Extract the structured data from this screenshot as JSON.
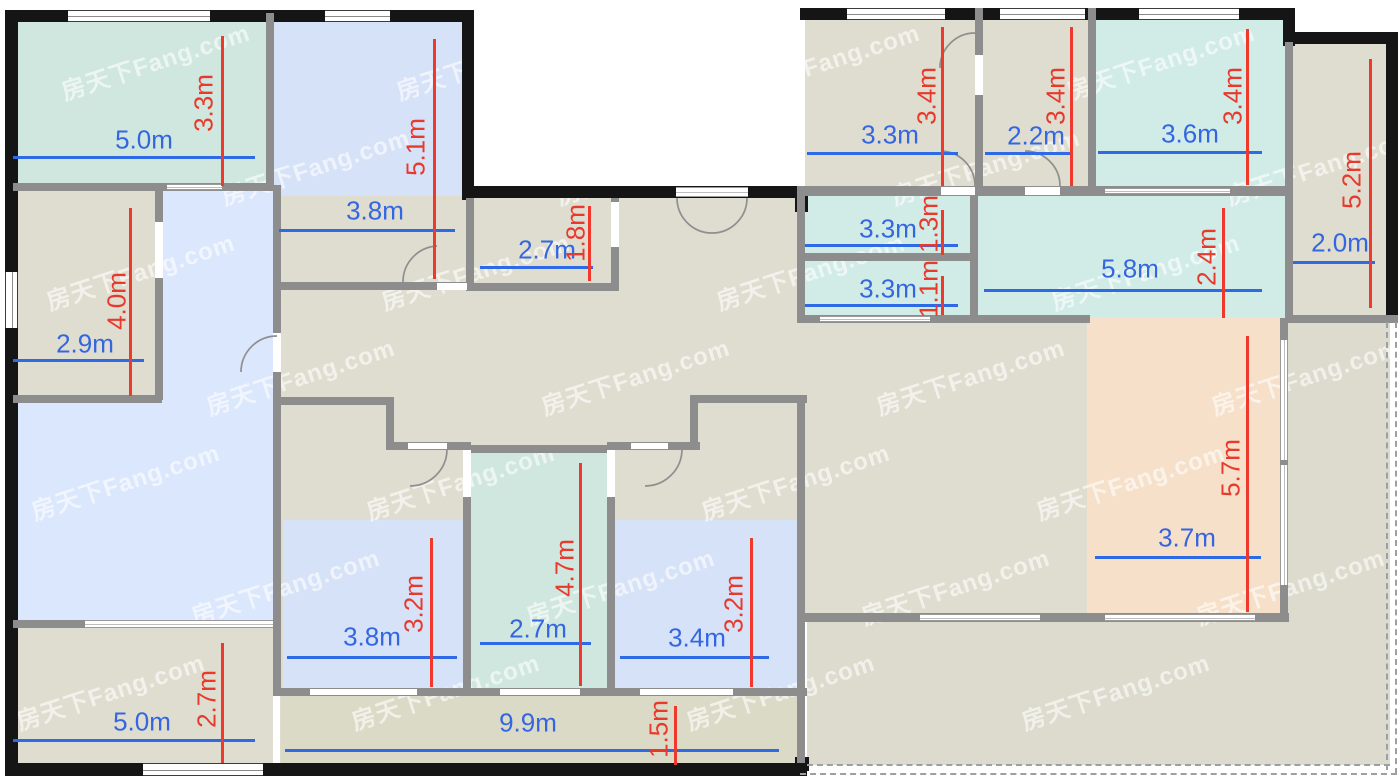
{
  "floorplan": {
    "width": 1400,
    "height": 779,
    "colors": {
      "wall_black": "#151515",
      "wall_gray": "#8d8d8d",
      "door_stroke": "#8f8f8f",
      "dash": "#9aa0a4",
      "dim_blue": "#2e6ae6",
      "dim_blue_text": "#3466e2",
      "dim_red": "#ee392c",
      "dim_red_text": "#e83a2c",
      "hall": "#deddcf",
      "balcony": "#dbdac7",
      "terrace": "#dcdbcd",
      "teal_a": "#cfe7de",
      "teal_b": "#d1ebe7",
      "blue_room": "#d6e2f8",
      "blue_living": "#dbe7fc",
      "peach": "#f6e0c9",
      "opening": "#ffffff"
    },
    "watermark": {
      "text": "房天下Fang.com",
      "color": "rgba(255,255,255,0.6)",
      "font_size": 24,
      "rotation": -18,
      "positions": [
        [
          155,
          60
        ],
        [
          490,
          60
        ],
        [
          825,
          60
        ],
        [
          1160,
          60
        ],
        [
          315,
          165
        ],
        [
          650,
          165
        ],
        [
          985,
          165
        ],
        [
          1320,
          165
        ],
        [
          140,
          270
        ],
        [
          475,
          270
        ],
        [
          810,
          270
        ],
        [
          1145,
          270
        ],
        [
          300,
          375
        ],
        [
          635,
          375
        ],
        [
          970,
          375
        ],
        [
          1305,
          375
        ],
        [
          125,
          480
        ],
        [
          460,
          480
        ],
        [
          795,
          480
        ],
        [
          1130,
          480
        ],
        [
          285,
          585
        ],
        [
          620,
          585
        ],
        [
          955,
          585
        ],
        [
          1290,
          585
        ],
        [
          110,
          690
        ],
        [
          445,
          690
        ],
        [
          780,
          690
        ],
        [
          1115,
          690
        ]
      ]
    },
    "fills": [
      {
        "name": "bedroom-top-left",
        "x": 13,
        "y": 13,
        "w": 253,
        "h": 172,
        "c": "teal_a"
      },
      {
        "name": "bedroom-5-1",
        "x": 273,
        "y": 13,
        "w": 191,
        "h": 271,
        "c": "blue_room"
      },
      {
        "name": "room-2-9",
        "x": 13,
        "y": 185,
        "w": 148,
        "h": 212,
        "c": "hall"
      },
      {
        "name": "corridor",
        "x": 161,
        "y": 189,
        "w": 112,
        "h": 215,
        "c": "blue_living"
      },
      {
        "name": "living-room",
        "x": 13,
        "y": 400,
        "w": 260,
        "h": 222,
        "c": "blue_living"
      },
      {
        "name": "room-bottom-left",
        "x": 13,
        "y": 626,
        "w": 260,
        "h": 139,
        "c": "hall"
      },
      {
        "name": "hall-left-wing",
        "x": 280,
        "y": 196,
        "w": 520,
        "h": 568,
        "c": "hall"
      },
      {
        "name": "balcony-bottom",
        "x": 281,
        "y": 694,
        "w": 519,
        "h": 70,
        "c": "balcony"
      },
      {
        "name": "hall-right-wing",
        "x": 800,
        "y": 196,
        "w": 290,
        "h": 419,
        "c": "hall"
      },
      {
        "name": "terrace-bottom",
        "x": 807,
        "y": 613,
        "w": 583,
        "h": 152,
        "c": "terrace"
      },
      {
        "name": "terrace-right",
        "x": 1285,
        "y": 318,
        "w": 105,
        "h": 297,
        "c": "terrace"
      },
      {
        "name": "room-top-right-1",
        "x": 805,
        "y": 13,
        "w": 172,
        "h": 175,
        "c": "hall"
      },
      {
        "name": "room-top-right-2",
        "x": 981,
        "y": 13,
        "w": 109,
        "h": 175,
        "c": "hall"
      },
      {
        "name": "room-3-6",
        "x": 1094,
        "y": 13,
        "w": 191,
        "h": 175,
        "c": "teal_b"
      },
      {
        "name": "room-1-3",
        "x": 803,
        "y": 194,
        "w": 169,
        "h": 61,
        "c": "teal_b"
      },
      {
        "name": "room-1-1",
        "x": 803,
        "y": 259,
        "w": 169,
        "h": 58,
        "c": "teal_b"
      },
      {
        "name": "area-5-8",
        "x": 976,
        "y": 194,
        "w": 312,
        "h": 124,
        "c": "teal_b"
      },
      {
        "name": "room-2-0",
        "x": 1291,
        "y": 42,
        "w": 97,
        "h": 275,
        "c": "hall"
      },
      {
        "name": "room-peach",
        "x": 1087,
        "y": 318,
        "w": 195,
        "h": 297,
        "c": "peach"
      },
      {
        "name": "roomA-blue",
        "x": 283,
        "y": 520,
        "w": 181,
        "h": 170,
        "c": "blue_room"
      },
      {
        "name": "roomB-teal",
        "x": 470,
        "y": 450,
        "w": 138,
        "h": 240,
        "c": "teal_a"
      },
      {
        "name": "roomC-blue",
        "x": 614,
        "y": 520,
        "w": 184,
        "h": 170,
        "c": "blue_room"
      }
    ],
    "black_walls": [
      [
        5,
        10,
        465,
        12
      ],
      [
        5,
        10,
        13,
        766
      ],
      [
        5,
        763,
        802,
        13
      ],
      [
        462,
        10,
        12,
        190
      ],
      [
        462,
        186,
        345,
        12
      ],
      [
        800,
        8,
        490,
        12
      ],
      [
        1283,
        8,
        12,
        38
      ],
      [
        1283,
        32,
        115,
        12
      ],
      [
        1386,
        32,
        12,
        286
      ],
      [
        795,
        186,
        13,
        26
      ],
      [
        795,
        757,
        14,
        14
      ]
    ],
    "gray_walls": [
      [
        13,
        183,
        253,
        8
      ],
      [
        266,
        13,
        8,
        178
      ],
      [
        155,
        190,
        8,
        210
      ],
      [
        13,
        395,
        149,
        8
      ],
      [
        273,
        185,
        8,
        503
      ],
      [
        13,
        620,
        75,
        8
      ],
      [
        273,
        397,
        120,
        8
      ],
      [
        386,
        397,
        8,
        53
      ],
      [
        386,
        442,
        84,
        8
      ],
      [
        463,
        442,
        8,
        251
      ],
      [
        470,
        445,
        140,
        8
      ],
      [
        607,
        442,
        8,
        251
      ],
      [
        614,
        442,
        86,
        8
      ],
      [
        690,
        397,
        8,
        53
      ],
      [
        690,
        395,
        117,
        8
      ],
      [
        273,
        688,
        534,
        8
      ],
      [
        800,
        186,
        490,
        10
      ],
      [
        797,
        253,
        181,
        8
      ],
      [
        797,
        315,
        293,
        8
      ],
      [
        1285,
        315,
        113,
        8
      ],
      [
        970,
        186,
        8,
        137
      ],
      [
        975,
        8,
        8,
        180
      ],
      [
        1088,
        8,
        8,
        180
      ],
      [
        1285,
        42,
        8,
        278
      ],
      [
        1280,
        318,
        8,
        303
      ],
      [
        797,
        613,
        492,
        9
      ],
      [
        797,
        186,
        8,
        137
      ],
      [
        611,
        198,
        8,
        92
      ],
      [
        466,
        283,
        153,
        8
      ],
      [
        466,
        198,
        8,
        92
      ],
      [
        273,
        282,
        194,
        8
      ],
      [
        797,
        395,
        8,
        368
      ]
    ],
    "ext_windows": [
      {
        "x": 68,
        "y": 10,
        "w": 142,
        "h": 12,
        "o": "h"
      },
      {
        "x": 325,
        "y": 10,
        "w": 65,
        "h": 12,
        "o": "h"
      },
      {
        "x": 847,
        "y": 8,
        "w": 98,
        "h": 12,
        "o": "h"
      },
      {
        "x": 1000,
        "y": 8,
        "w": 85,
        "h": 12,
        "o": "h"
      },
      {
        "x": 1139,
        "y": 8,
        "w": 100,
        "h": 12,
        "o": "h"
      },
      {
        "x": 5,
        "y": 272,
        "w": 13,
        "h": 56,
        "o": "v"
      },
      {
        "x": 143,
        "y": 763,
        "w": 120,
        "h": 13,
        "o": "h"
      }
    ],
    "white_openings": [
      [
        155,
        222,
        8,
        56
      ],
      [
        273,
        333,
        8,
        39
      ],
      [
        408,
        443,
        39,
        6
      ],
      [
        463,
        450,
        8,
        47
      ],
      [
        607,
        450,
        8,
        47
      ],
      [
        631,
        443,
        37,
        6
      ],
      [
        310,
        689,
        107,
        6
      ],
      [
        500,
        689,
        80,
        6
      ],
      [
        640,
        689,
        93,
        6
      ],
      [
        941,
        187,
        34,
        8
      ],
      [
        1025,
        187,
        35,
        8
      ],
      [
        975,
        55,
        8,
        40
      ],
      [
        611,
        202,
        8,
        45
      ],
      [
        437,
        283,
        30,
        7
      ]
    ],
    "lined_openings": [
      {
        "x": 167,
        "y": 184,
        "w": 55,
        "h": 6,
        "o": "h"
      },
      {
        "x": 85,
        "y": 620,
        "w": 188,
        "h": 8,
        "o": "h"
      },
      {
        "x": 676,
        "y": 187,
        "w": 72,
        "h": 10,
        "o": "h"
      },
      {
        "x": 1105,
        "y": 188,
        "w": 125,
        "h": 6,
        "o": "h"
      },
      {
        "x": 820,
        "y": 316,
        "w": 110,
        "h": 6,
        "o": "h"
      },
      {
        "x": 1280,
        "y": 340,
        "w": 8,
        "h": 120,
        "o": "v"
      },
      {
        "x": 1280,
        "y": 465,
        "w": 8,
        "h": 120,
        "o": "v"
      },
      {
        "x": 920,
        "y": 614,
        "w": 120,
        "h": 7,
        "o": "h"
      },
      {
        "x": 1105,
        "y": 614,
        "w": 150,
        "h": 7,
        "o": "h"
      }
    ],
    "dashed": [
      {
        "x": 1386,
        "y": 322,
        "len": 448,
        "o": "v"
      },
      {
        "x": 1395,
        "y": 322,
        "len": 452,
        "o": "v"
      },
      {
        "x": 807,
        "y": 764,
        "len": 583,
        "o": "h"
      },
      {
        "x": 800,
        "y": 773,
        "len": 597,
        "o": "h"
      }
    ],
    "doors": [
      "M 677 198 A 35 35 0 0 0 712 233",
      "M 747 198 A 35 35 0 0 1 712 233",
      "M 403 282 A 36 36 0 0 1 437 246",
      "M 277 336 A 36 36 0 0 0 241 372",
      "M 410 486 A 37 37 0 0 0 447 449",
      "M 645 486 A 37 37 0 0 0 682 449",
      "M 941 151 A 35 35 0 0 1 975 186",
      "M 1025 151 A 35 35 0 0 1 1060 186",
      "M 940 68 A 35 35 0 0 1 975 33"
    ],
    "dims_h": [
      {
        "label": "5.0m",
        "x1": 13,
        "x2": 265,
        "y": 157,
        "lx": 144,
        "ly": 140
      },
      {
        "label": "3.8m",
        "x1": 279,
        "x2": 465,
        "y": 230,
        "lx": 375,
        "ly": 211
      },
      {
        "label": "2.7m",
        "x1": 480,
        "x2": 603,
        "y": 267,
        "lx": 547,
        "ly": 250
      },
      {
        "label": "2.9m",
        "x1": 13,
        "x2": 154,
        "y": 360,
        "lx": 85,
        "ly": 344
      },
      {
        "label": "3.3m",
        "x1": 807,
        "x2": 968,
        "y": 153,
        "lx": 890,
        "ly": 135
      },
      {
        "label": "2.2m",
        "x1": 985,
        "x2": 1082,
        "y": 153,
        "lx": 1036,
        "ly": 136
      },
      {
        "label": "3.6m",
        "x1": 1098,
        "x2": 1272,
        "y": 152,
        "lx": 1190,
        "ly": 134
      },
      {
        "label": "3.3m",
        "x1": 805,
        "x2": 968,
        "y": 245,
        "lx": 888,
        "ly": 229
      },
      {
        "label": "3.3m",
        "x1": 805,
        "x2": 968,
        "y": 305,
        "lx": 888,
        "ly": 289
      },
      {
        "label": "5.8m",
        "x1": 984,
        "x2": 1272,
        "y": 290,
        "lx": 1130,
        "ly": 269
      },
      {
        "label": "2.0m",
        "x1": 1293,
        "x2": 1385,
        "y": 262,
        "lx": 1340,
        "ly": 243
      },
      {
        "label": "3.7m",
        "x1": 1095,
        "x2": 1271,
        "y": 557,
        "lx": 1187,
        "ly": 538
      },
      {
        "label": "3.8m",
        "x1": 287,
        "x2": 467,
        "y": 657,
        "lx": 372,
        "ly": 637
      },
      {
        "label": "2.7m",
        "x1": 480,
        "x2": 601,
        "y": 643,
        "lx": 538,
        "ly": 629
      },
      {
        "label": "3.4m",
        "x1": 620,
        "x2": 779,
        "y": 657,
        "lx": 697,
        "ly": 638
      },
      {
        "label": "5.0m",
        "x1": 13,
        "x2": 265,
        "y": 740,
        "lx": 142,
        "ly": 722
      },
      {
        "label": "9.9m",
        "x1": 285,
        "x2": 789,
        "y": 750,
        "lx": 528,
        "ly": 723
      }
    ],
    "dims_v": [
      {
        "label": "3.3m",
        "x": 222,
        "y1": 25,
        "y2": 186,
        "lx": 204,
        "ly": 103
      },
      {
        "label": "5.1m",
        "x": 434,
        "y1": 28,
        "y2": 279,
        "lx": 416,
        "ly": 147
      },
      {
        "label": "1.8m",
        "x": 589,
        "y1": 195,
        "y2": 281,
        "lx": 576,
        "ly": 233
      },
      {
        "label": "4.0m",
        "x": 130,
        "y1": 197,
        "y2": 396,
        "lx": 117,
        "ly": 301
      },
      {
        "label": "3.4m",
        "x": 942,
        "y1": 16,
        "y2": 186,
        "lx": 927,
        "ly": 96
      },
      {
        "label": "3.4m",
        "x": 1071,
        "y1": 16,
        "y2": 186,
        "lx": 1056,
        "ly": 96
      },
      {
        "label": "3.4m",
        "x": 1247,
        "y1": 18,
        "y2": 185,
        "lx": 1233,
        "ly": 96
      },
      {
        "label": "5.2m",
        "x": 1370,
        "y1": 48,
        "y2": 308,
        "lx": 1352,
        "ly": 180
      },
      {
        "label": "1.3m",
        "x": 942,
        "y1": 199,
        "y2": 255,
        "lx": 929,
        "ly": 224
      },
      {
        "label": "1.1m",
        "x": 942,
        "y1": 265,
        "y2": 315,
        "lx": 929,
        "ly": 289
      },
      {
        "label": "2.4m",
        "x": 1223,
        "y1": 197,
        "y2": 318,
        "lx": 1207,
        "ly": 257
      },
      {
        "label": "5.7m",
        "x": 1247,
        "y1": 325,
        "y2": 612,
        "lx": 1231,
        "ly": 468
      },
      {
        "label": "3.2m",
        "x": 431,
        "y1": 527,
        "y2": 687,
        "lx": 414,
        "ly": 604
      },
      {
        "label": "4.7m",
        "x": 580,
        "y1": 452,
        "y2": 686,
        "lx": 565,
        "ly": 568
      },
      {
        "label": "3.2m",
        "x": 751,
        "y1": 527,
        "y2": 687,
        "lx": 734,
        "ly": 604
      },
      {
        "label": "2.7m",
        "x": 222,
        "y1": 632,
        "y2": 763,
        "lx": 207,
        "ly": 699
      },
      {
        "label": "1.5m",
        "x": 675,
        "y1": 695,
        "y2": 765,
        "lx": 659,
        "ly": 729
      }
    ]
  }
}
